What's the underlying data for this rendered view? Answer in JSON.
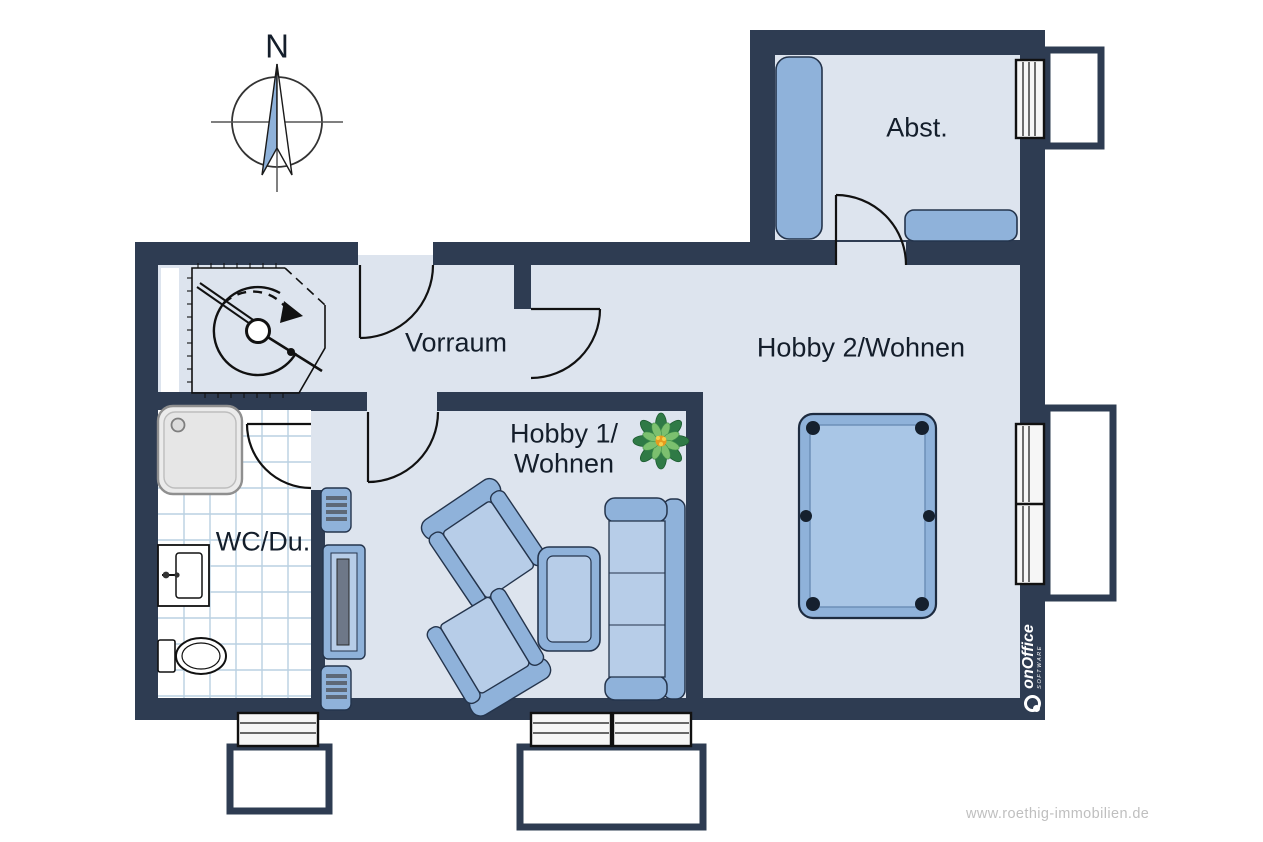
{
  "compass": {
    "label": "N"
  },
  "rooms": {
    "abst": {
      "label": "Abst."
    },
    "vorraum": {
      "label": "Vorraum"
    },
    "hobby1": {
      "label_line1": "Hobby 1/",
      "label_line2": "Wohnen"
    },
    "hobby2": {
      "label": "Hobby 2/Wohnen"
    },
    "wc": {
      "label": "WC/Du."
    }
  },
  "branding": {
    "software_logo": "onOffice",
    "software_sub": "SOFTWARE",
    "watermark": "www.roethig-immobilien.de"
  },
  "icons": {
    "compass": "compass-rose-icon",
    "plant": "plant-icon",
    "stairs": "spiral-stairs-icon",
    "billiard": "billiard-table-icon",
    "sofa": "sofa-icon",
    "armchair": "armchair-icon",
    "coffee_table": "coffee-table-icon",
    "tv_unit": "tv-unit-icon",
    "shower": "shower-icon",
    "sink": "sink-icon",
    "toilet": "toilet-icon",
    "wardrobe": "wardrobe-icon",
    "sideboard": "sideboard-icon"
  },
  "colors": {
    "wall": "#2e3c52",
    "floor": "#dde4ee",
    "furniture": "#8fb2da",
    "furniture_light": "#b7cde8",
    "billiard_felt": "#a9c6e6",
    "line": "#111111",
    "tile_line": "#bad0e2",
    "watermark": "#bfbfbf"
  }
}
